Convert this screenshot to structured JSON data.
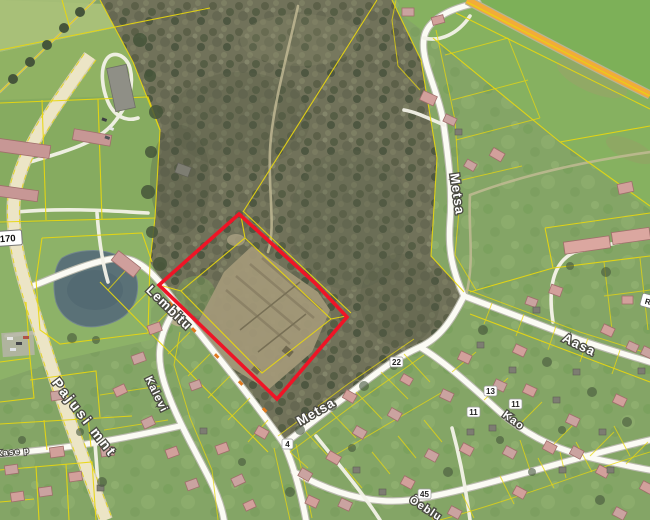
{
  "map": {
    "type_label": "aerial cadastral map",
    "highlight_color": "#ef1426",
    "parcel_line_color": "#e8d70f",
    "main_road_color": "#f2ac38",
    "labels": {
      "pajusi": "Pajusi mnt",
      "lembitu": "Lembitu",
      "kalevi": "Kalevi",
      "metsa_lower": "Metsa",
      "metsa_upper": "Metsa",
      "aasa": "Aasa",
      "kao": "Kao",
      "oeblu": "Õeblu",
      "kase": "Kase p",
      "edge": "R",
      "road_number": "4170"
    },
    "house_numbers": {
      "b22": "22",
      "b13": "13",
      "b11a": "11",
      "b11b": "11",
      "b4": "4",
      "b45": "45"
    }
  }
}
